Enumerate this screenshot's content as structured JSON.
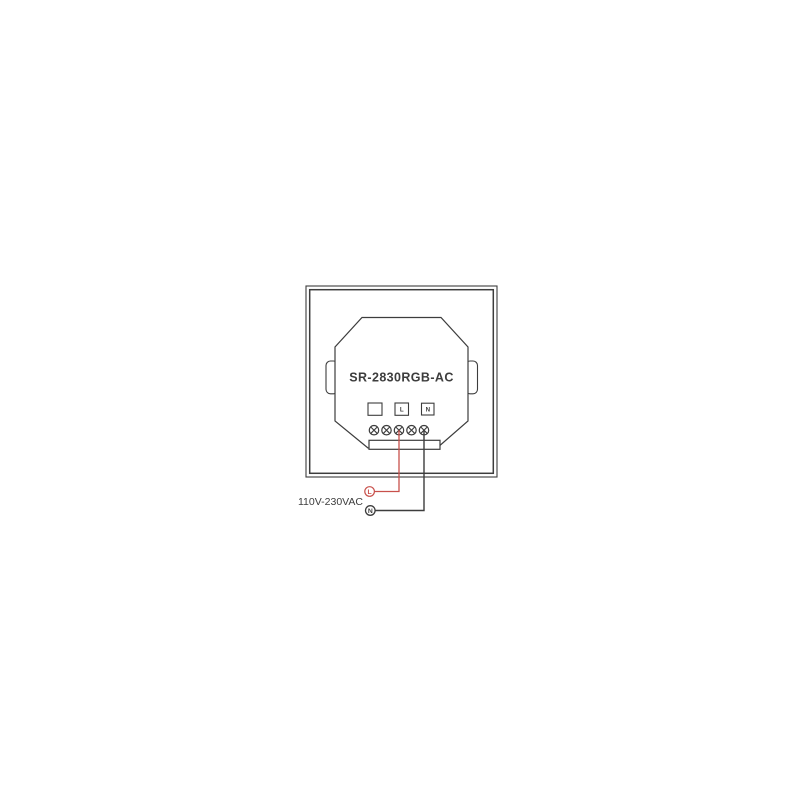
{
  "diagram": {
    "device_model": "SR-2830RGB-AC",
    "power_rating_label": "110V-230VAC",
    "terminal_boxes": [
      {
        "label": ""
      },
      {
        "label": "L"
      },
      {
        "label": "N"
      }
    ],
    "wire_markers": {
      "live_label": "L",
      "neutral_label": "N"
    },
    "screw_terminal_count": 5,
    "colors": {
      "outline": "#3d3d3d",
      "live_wire": "#c8504b",
      "neutral_wire": "#3d3d3d",
      "background": "#ffffff"
    }
  }
}
